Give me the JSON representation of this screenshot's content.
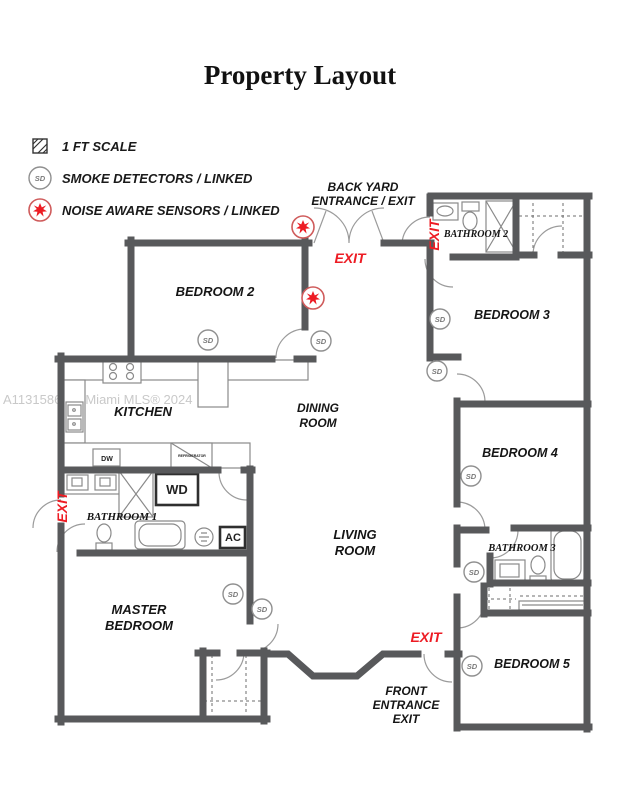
{
  "title": "Property Layout",
  "watermark": "A11315862 © Miami MLS® 2024",
  "legend": {
    "items": [
      {
        "icon": "scale-swatch-icon",
        "label": "1 FT SCALE"
      },
      {
        "icon": "smoke-detector-icon",
        "label": "SMOKE DETECTORS / LINKED"
      },
      {
        "icon": "noise-sensor-icon",
        "label": "NOISE AWARE SENSORS / LINKED"
      }
    ]
  },
  "colors": {
    "wall": "#58595b",
    "exit_red": "#ed1c24",
    "sensor_red": "#cf5b5b",
    "detector_ring": "#8f8f8f",
    "fixture_line": "#8a8a8a",
    "watermark": "#c9c9c9"
  },
  "floorplan": {
    "sd_label": "SD",
    "room_labels": [
      {
        "id": "bedroom-2",
        "lines": [
          "BEDROOM 2"
        ],
        "x": 215,
        "y": 296,
        "size": 13
      },
      {
        "id": "kitchen",
        "lines": [
          "KITCHEN"
        ],
        "x": 143,
        "y": 416,
        "size": 13
      },
      {
        "id": "dining-room",
        "lines": [
          "DINING",
          "ROOM"
        ],
        "x": 318,
        "y": 412,
        "size": 12
      },
      {
        "id": "living-room",
        "lines": [
          "LIVING",
          "ROOM"
        ],
        "x": 355,
        "y": 539,
        "size": 13
      },
      {
        "id": "master-bedroom",
        "lines": [
          "MASTER",
          "BEDROOM"
        ],
        "x": 139,
        "y": 614,
        "size": 13
      },
      {
        "id": "bathroom-1",
        "lines": [
          "BATHROOM 1"
        ],
        "x": 122,
        "y": 520,
        "size": 11,
        "serif": true
      },
      {
        "id": "bathroom-2",
        "lines": [
          "BATHROOM 2"
        ],
        "x": 476,
        "y": 237,
        "size": 10,
        "serif": true
      },
      {
        "id": "bathroom-3",
        "lines": [
          "BATHROOM 3"
        ],
        "x": 522,
        "y": 551,
        "size": 10.5,
        "serif": true
      },
      {
        "id": "bedroom-3",
        "lines": [
          "BEDROOM 3"
        ],
        "x": 512,
        "y": 319,
        "size": 12.5
      },
      {
        "id": "bedroom-4",
        "lines": [
          "BEDROOM 4"
        ],
        "x": 520,
        "y": 457,
        "size": 12.5
      },
      {
        "id": "bedroom-5",
        "lines": [
          "BEDROOM 5"
        ],
        "x": 532,
        "y": 668,
        "size": 12.5
      }
    ],
    "entrance_labels": [
      {
        "id": "back-yard-entrance",
        "lines": [
          "BACK YARD",
          "ENTRANCE / EXIT"
        ],
        "x": 363,
        "y": 191
      },
      {
        "id": "front-entrance",
        "lines": [
          "FRONT",
          "ENTRANCE",
          "EXIT"
        ],
        "x": 406,
        "y": 695
      }
    ],
    "exit_labels": [
      {
        "id": "exit-back-yard",
        "text": "EXIT",
        "x": 350,
        "y": 263,
        "rotate": 0
      },
      {
        "id": "exit-bathroom-2",
        "text": "EXIT",
        "x": 439,
        "y": 235,
        "rotate": -90
      },
      {
        "id": "exit-bathroom-1",
        "text": "EXIT",
        "x": 67,
        "y": 507,
        "rotate": -90
      },
      {
        "id": "exit-front",
        "text": "EXIT",
        "x": 426,
        "y": 642,
        "rotate": 0
      }
    ],
    "smoke_detectors": [
      {
        "x": 208,
        "y": 340
      },
      {
        "x": 321,
        "y": 341
      },
      {
        "x": 440,
        "y": 319
      },
      {
        "x": 437,
        "y": 371
      },
      {
        "x": 471,
        "y": 476
      },
      {
        "x": 474,
        "y": 572
      },
      {
        "x": 472,
        "y": 666
      },
      {
        "x": 233,
        "y": 594
      },
      {
        "x": 262,
        "y": 609
      }
    ],
    "noise_sensors": [
      {
        "x": 303,
        "y": 227
      },
      {
        "x": 313,
        "y": 298
      }
    ],
    "fixture_labels": [
      {
        "id": "dishwasher",
        "text": "DW",
        "x": 107,
        "y": 461,
        "size": 7
      },
      {
        "id": "washer-dryer",
        "text": "WD",
        "x": 177,
        "y": 494,
        "size": 13
      },
      {
        "id": "ac-unit",
        "text": "AC",
        "x": 233,
        "y": 541,
        "size": 11
      },
      {
        "id": "refrigerator",
        "text": "REFRIGERATOR",
        "x": 192,
        "y": 457,
        "size": 3.5
      }
    ]
  }
}
